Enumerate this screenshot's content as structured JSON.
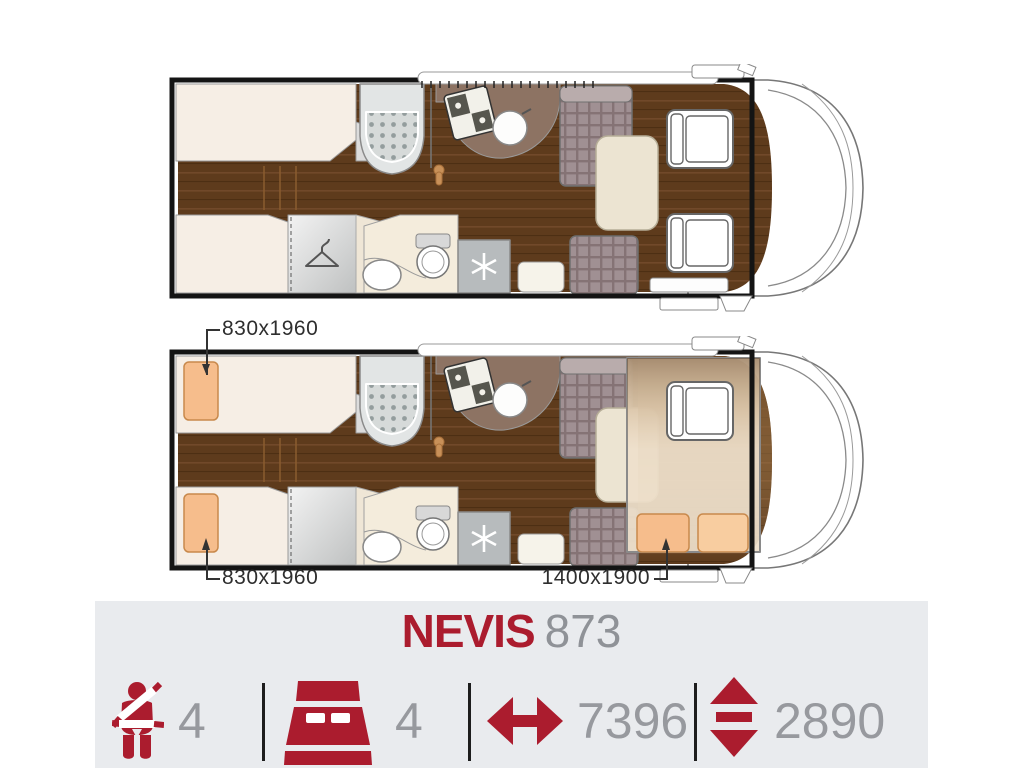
{
  "model": {
    "name": "NEVIS",
    "variant": "873"
  },
  "dimension_labels": {
    "rear_bed_top": "830x1960",
    "rear_bed_bottom": "830x1960",
    "drop_down_bed": "1400x1900"
  },
  "spec_bar": {
    "background": "#e9ebee",
    "accent_color": "#ab1c2e",
    "value_color": "#97999e",
    "specs": [
      {
        "icon": "seatbelt-passenger-icon",
        "value": "4"
      },
      {
        "icon": "double-bed-icon",
        "value": "4"
      },
      {
        "icon": "horizontal-double-arrow-icon",
        "value": "7396"
      },
      {
        "icon": "vertical-double-arrow-icon",
        "value": "2890"
      }
    ]
  },
  "floorplans": {
    "day": {
      "feature_icons": [
        "shower-icon",
        "stove-icon",
        "kitchen-sink-icon",
        "hanger-icon",
        "toilet-icon",
        "bathroom-sink-icon",
        "snowflake-icon",
        "dinette-table",
        "cab-seats"
      ]
    },
    "night": {
      "feature_icons": [
        "rear-single-bed-pillow",
        "rear-single-bed-pillow",
        "drop-down-bed-pillows"
      ]
    },
    "floor_color": "#5e3b1c",
    "pillow_color": "#f6bd8c"
  }
}
